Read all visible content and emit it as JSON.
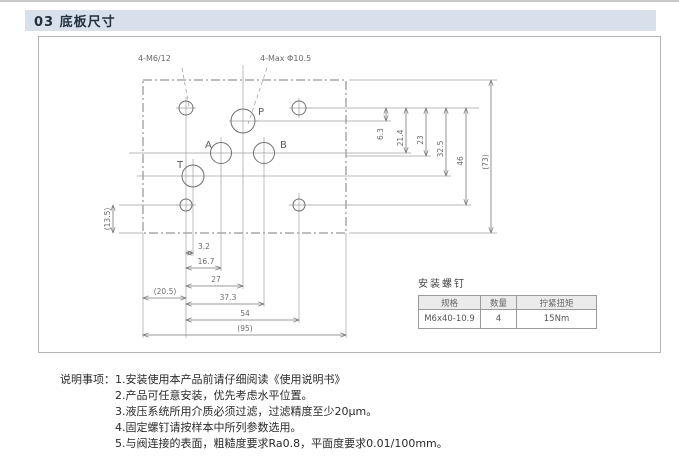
{
  "header": {
    "title": "03  底板尺寸"
  },
  "drawing": {
    "callouts": {
      "thread_holes": "4-M6/12",
      "max_ports": "4-Max Φ10.5"
    },
    "ports": {
      "p": "P",
      "a": "A",
      "b": "B",
      "t": "T"
    },
    "dims_bottom": [
      "3.2",
      "16.7",
      "27",
      "(20.5)",
      "37.3",
      "54",
      "(95)"
    ],
    "dims_right": [
      "6.3",
      "21.4",
      "23",
      "32.5",
      "46",
      "(73)"
    ],
    "dims_left": [
      "(13.5)"
    ]
  },
  "screw_table": {
    "title": "安装螺钉",
    "headers": [
      "规格",
      "数量",
      "拧紧扭矩"
    ],
    "row": [
      "M6x40-10.9",
      "4",
      "15Nm"
    ]
  },
  "notes": {
    "label": "说明事项：",
    "items": [
      "1.安装使用本产品前请仔细阅读《使用说明书》",
      "2.产品可任意安装，优先考虑水平位置。",
      "3.液压系统所用介质必须过滤，过滤精度至少20μm。",
      "4.固定螺钉请按样本中所列参数选用。",
      "5.与阀连接的表面，粗糙度要求Ra0.8，平面度要求0.01/100mm。"
    ]
  }
}
